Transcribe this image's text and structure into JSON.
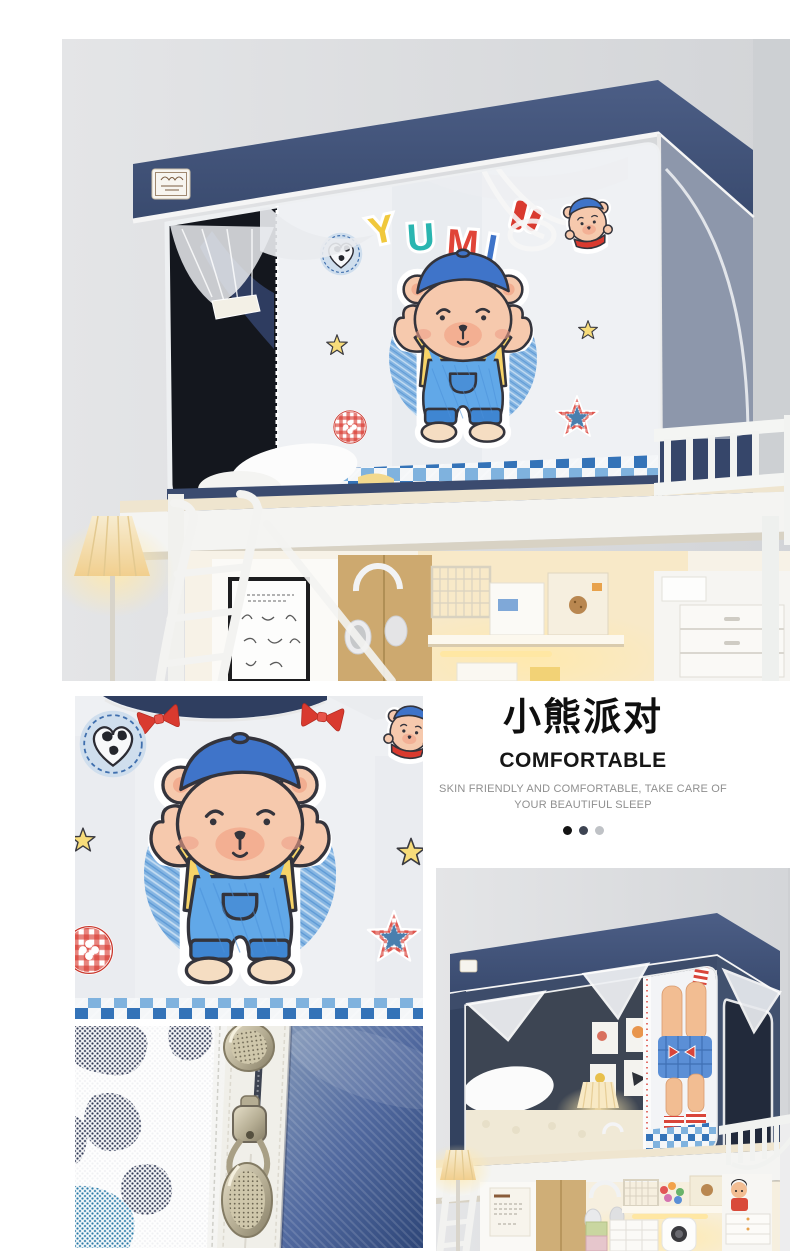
{
  "intro": {
    "title": "小熊派对",
    "subtitle": "COMFORTABLE",
    "tagline_line1": "SKIN FRIENDLY AND COMFORTABLE, TAKE CARE OF",
    "tagline_line2": "YOUR BEAUTIFUL SLEEP",
    "dot_styles": [
      "background:#141414",
      "background:#3d4452",
      "background:#bfc2c6"
    ]
  },
  "photos": {
    "hero": {
      "label": "bunk bed with navy bear-print mosquito net curtain, desk below, front view"
    },
    "print_closeup": {
      "label": "close-up of bear party print curtain fabric"
    },
    "zipper_closeup": {
      "label": "close-up of double zipper pulls, mesh and denim fabric"
    },
    "angle_view": {
      "label": "bunk bed mosquito net with opened curtain, angled view"
    }
  },
  "print": {
    "letters": [
      {
        "char": "Y",
        "color": "#f0c83c"
      },
      {
        "char": "U",
        "color": "#2ab5b0"
      },
      {
        "char": "M",
        "color": "#e04438"
      },
      {
        "char": "I",
        "color": "#3f74c9"
      }
    ]
  },
  "colors": {
    "canopy_navy": "#41527a",
    "side_face_gray": "#8d97ab",
    "interior_black": "#15181f",
    "interior_slate": "#3d4654",
    "curtain_white": "#f0f2f5",
    "checker_blue": "#3473b8",
    "checker_light": "#7fb2de",
    "gingham_red": "#d8382e",
    "denim_blue": "#49639b",
    "accent_yellow": "#f7d468",
    "bear_skin": "#f6c9ad",
    "warm_light": "#ffe7a3"
  }
}
